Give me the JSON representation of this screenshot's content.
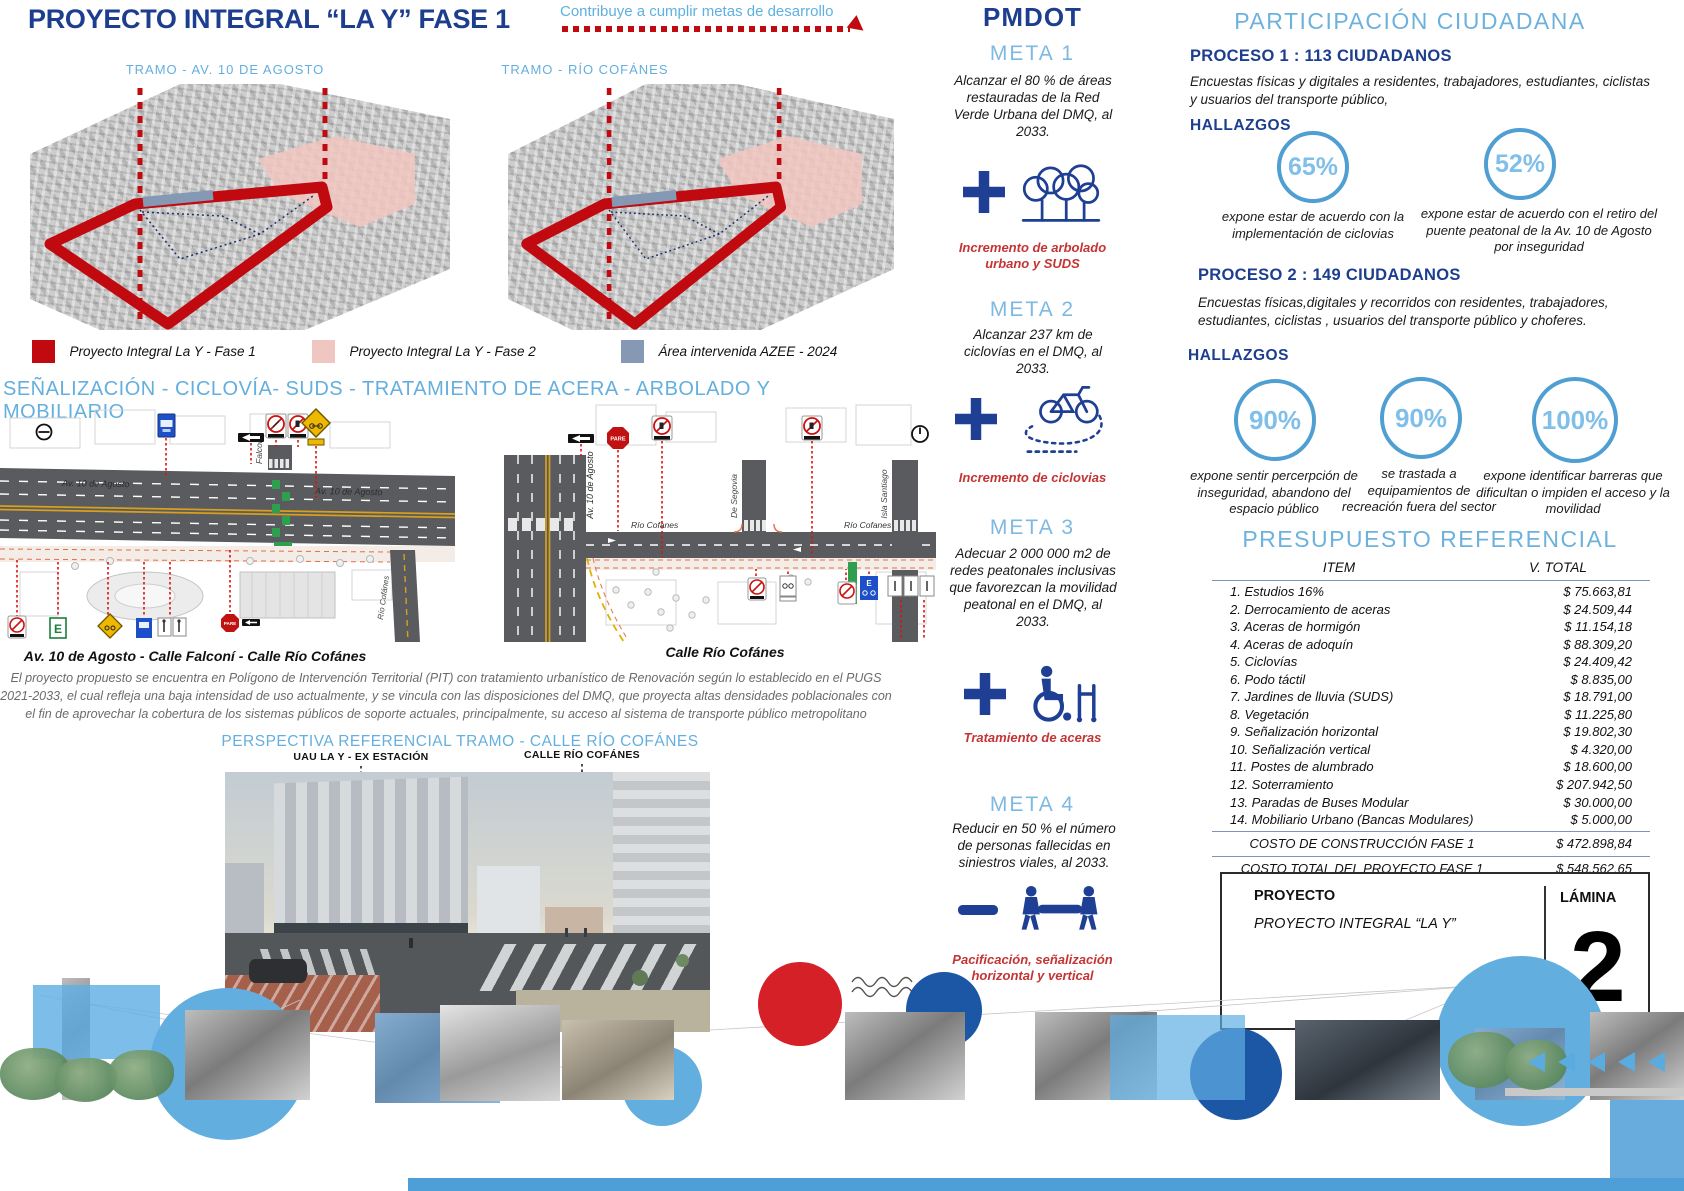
{
  "colors": {
    "navy": "#1d3e8f",
    "light_blue": "#64afde",
    "fase1_red": "#c00a10",
    "fase2_pink": "#f0c6c1",
    "azee_slate": "#8598b4",
    "caption_red": "#c53434",
    "bottom_bar_blue": "#4e9ed8"
  },
  "icons": {
    "meta1": "trees-icon",
    "meta2": "bicycle-icon",
    "meta3": "wheelchair-icon",
    "meta4": "stretcher-icon",
    "plus": "plus-icon",
    "minus": "minus-icon"
  },
  "header": {
    "title": "PROYECTO INTEGRAL “LA Y” FASE 1",
    "tagline": "Contribuye a cumplir metas de desarrollo"
  },
  "maps": {
    "left_label": "TRAMO - AV. 10 DE AGOSTO",
    "right_label": "TRAMO - RÍO COFÁNES",
    "legend": [
      {
        "label": "Proyecto Integral La Y - Fase 1",
        "color": "#c00a10"
      },
      {
        "label": "Proyecto Integral La Y - Fase 2",
        "color": "#f0c6c1"
      },
      {
        "label": "Área intervenida AZEE - 2024",
        "color": "#8598b4"
      }
    ]
  },
  "senalizacion": {
    "header": "SEÑALIZACIÓN - CICLOVÍA- SUDS - TRATAMIENTO DE ACERA - ARBOLADO Y MOBILIARIO"
  },
  "diagrams": {
    "left": {
      "av10_a": "Av. 10 de Agosto",
      "av10_b": "Av. 10 de Agosto",
      "falconi": "Falconí",
      "rio_cofanes": "Río Cofánes",
      "caption": "Av. 10 de Agosto  - Calle Falconí - Calle Río Cofánes"
    },
    "right": {
      "av10": "Av. 10 de Agosto",
      "rio_a": "Río Cofanes",
      "rio_b": "Río Cofanes",
      "de_segovia": "De Segovia",
      "isla_santiago": "Isla Santiago",
      "caption": "Calle Río Cofánes"
    },
    "pare": "PARE",
    "e": "E"
  },
  "paragraph": "El proyecto propuesto se encuentra en Polígono de Intervención Territorial (PIT) con tratamiento urbanístico de Renovación según lo establecido en el PUGS 2021-2033, el cual refleja una baja intensidad de uso actualmente, y se vincula con las disposiciones del DMQ, que proyecta altas densidades poblacionales con el fin de aprovechar la cobertura de los sistemas públicos de soporte actuales, principalmente, su acceso al sistema de transporte público metropolitano",
  "perspectiva": {
    "header": "PERSPECTIVA REFERENCIAL TRAMO - CALLE RÍO COFÁNES",
    "label_left": "UAU LA Y - EX ESTACIÓN",
    "label_right": "CALLE RÍO COFÁNES"
  },
  "pmdot": {
    "title": "PMDOT",
    "metas": [
      {
        "name": "META 1",
        "text": "Alcanzar el 80 % de áreas restauradas de la Red Verde Urbana del DMQ, al 2033.",
        "caption": "Incremento de arbolado urbano y SUDS"
      },
      {
        "name": "META 2",
        "text": "Alcanzar 237 km de ciclovías en el DMQ, al 2033.",
        "caption": "Incremento de ciclovias"
      },
      {
        "name": "META 3",
        "text": "Adecuar 2 000 000 m2 de redes peatonales inclusivas que favorezcan la movilidad peatonal en el DMQ, al 2033.",
        "caption": "Tratamiento de aceras"
      },
      {
        "name": "META 4",
        "text": "Reducir en 50 % el número de personas fallecidas en siniestros viales, al 2033.",
        "caption": "Pacificación, señalización horizontal y vertical"
      }
    ]
  },
  "participacion": {
    "title": "PARTICIPACIÓN CIUDADANA",
    "procesos": [
      {
        "header": "PROCESO 1 : 113 CIUDADANOS",
        "desc": "Encuestas físicas y digitales a residentes, trabajadores, estudiantes, ciclistas y usuarios del transporte público,",
        "hallazgos_label": "HALLAZGOS",
        "findings": [
          {
            "pct": "65%",
            "caption": "expone  estar de acuerdo con la implementación de ciclovias"
          },
          {
            "pct": "52%",
            "caption": "expone  estar de acuerdo con el retiro del puente peatonal de la Av. 10 de Agosto por inseguridad"
          }
        ]
      },
      {
        "header": "PROCESO 2 : 149 CIUDADANOS",
        "desc": "Encuestas físicas,digitales y recorridos con residentes, trabajadores, estudiantes, ciclistas , usuarios del transporte público y choferes.",
        "hallazgos_label": "HALLAZGOS",
        "findings": [
          {
            "pct": "90%",
            "caption": "expone sentir percerpción de inseguridad,  abandono del espacio público"
          },
          {
            "pct": "90%",
            "caption": "se trastada a equipamientos de recreación fuera del sector"
          },
          {
            "pct": "100%",
            "caption": "expone identificar barreras que dificultan o impiden el acceso y la movilidad"
          }
        ]
      }
    ]
  },
  "presupuesto": {
    "title": "PRESUPUESTO REFERENCIAL",
    "col_item": "ITEM",
    "col_total": "V. TOTAL",
    "rows": [
      {
        "item": "1. Estudios 16%",
        "total": "$ 75.663,81"
      },
      {
        "item": "2. Derrocamiento de aceras",
        "total": "$ 24.509,44"
      },
      {
        "item": "3. Aceras de hormigón",
        "total": "$ 11.154,18"
      },
      {
        "item": "4. Aceras de adoquín",
        "total": "$ 88.309,20"
      },
      {
        "item": "5. Ciclovías",
        "total": "$ 24.409,42"
      },
      {
        "item": "6. Podo táctil",
        "total": "$ 8.835,00"
      },
      {
        "item": "7. Jardines de lluvia (SUDS)",
        "total": "$ 18.791,00"
      },
      {
        "item": "8. Vegetación",
        "total": "$ 11.225,80"
      },
      {
        "item": "9. Señalización horizontal",
        "total": "$ 19.802,30"
      },
      {
        "item": "10. Señalización vertical",
        "total": "$ 4.320,00"
      },
      {
        "item": "11. Postes de alumbrado",
        "total": "$ 18.600,00"
      },
      {
        "item": "12. Soterramiento",
        "total": "$ 207.942,50"
      },
      {
        "item": "13. Paradas de Buses Modular",
        "total": "$ 30.000,00"
      },
      {
        "item": "14. Mobiliario Urbano (Bancas Modulares)",
        "total": "$ 5.000,00"
      }
    ],
    "subtotal_label": "COSTO DE CONSTRUCCIÓN FASE 1",
    "subtotal": "$ 472.898,84",
    "total_label": "COSTO TOTAL DEL PROYECTO FASE 1",
    "total": "$ 548.562,65"
  },
  "titleblock": {
    "proyecto_label": "PROYECTO",
    "proyecto_name": "PROYECTO INTEGRAL “LA Y”",
    "lamina_label": "LÁMINA",
    "lamina_number": "2"
  }
}
